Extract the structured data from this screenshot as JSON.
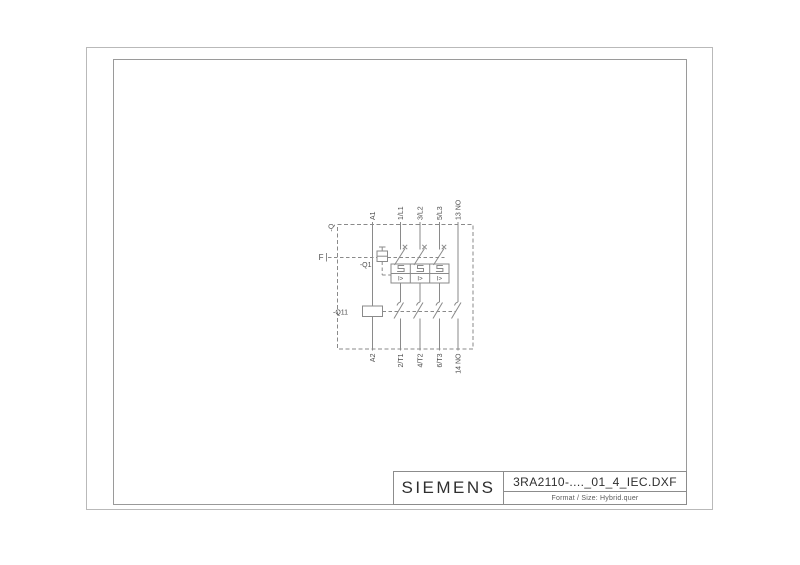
{
  "drawing": {
    "title_block": {
      "brand": "SIEMENS",
      "filename": "3RA2110-...._01_4_IEC.DXF",
      "format_label": "Format / Size: Hybrid.quer"
    },
    "schematic": {
      "enclosure_ref": "-Q",
      "release_ref": "F",
      "breaker_ref": "-Q1",
      "contactor_ref": "-Q11",
      "magnetic_trip_symbol": "I>",
      "top_terminals": [
        "A1",
        "1/L1",
        "3/L2",
        "5/L3",
        "13 NO"
      ],
      "bottom_terminals": [
        "A2",
        "2/T1",
        "4/T2",
        "6/T3",
        "14 NO"
      ]
    },
    "colors": {
      "schematic_line": "#8a8a8a",
      "label_text": "#4d4d4d",
      "outer_border": "#b9b9b9",
      "inner_border": "#9a9a9a",
      "title_text": "#2f2f2f"
    }
  }
}
